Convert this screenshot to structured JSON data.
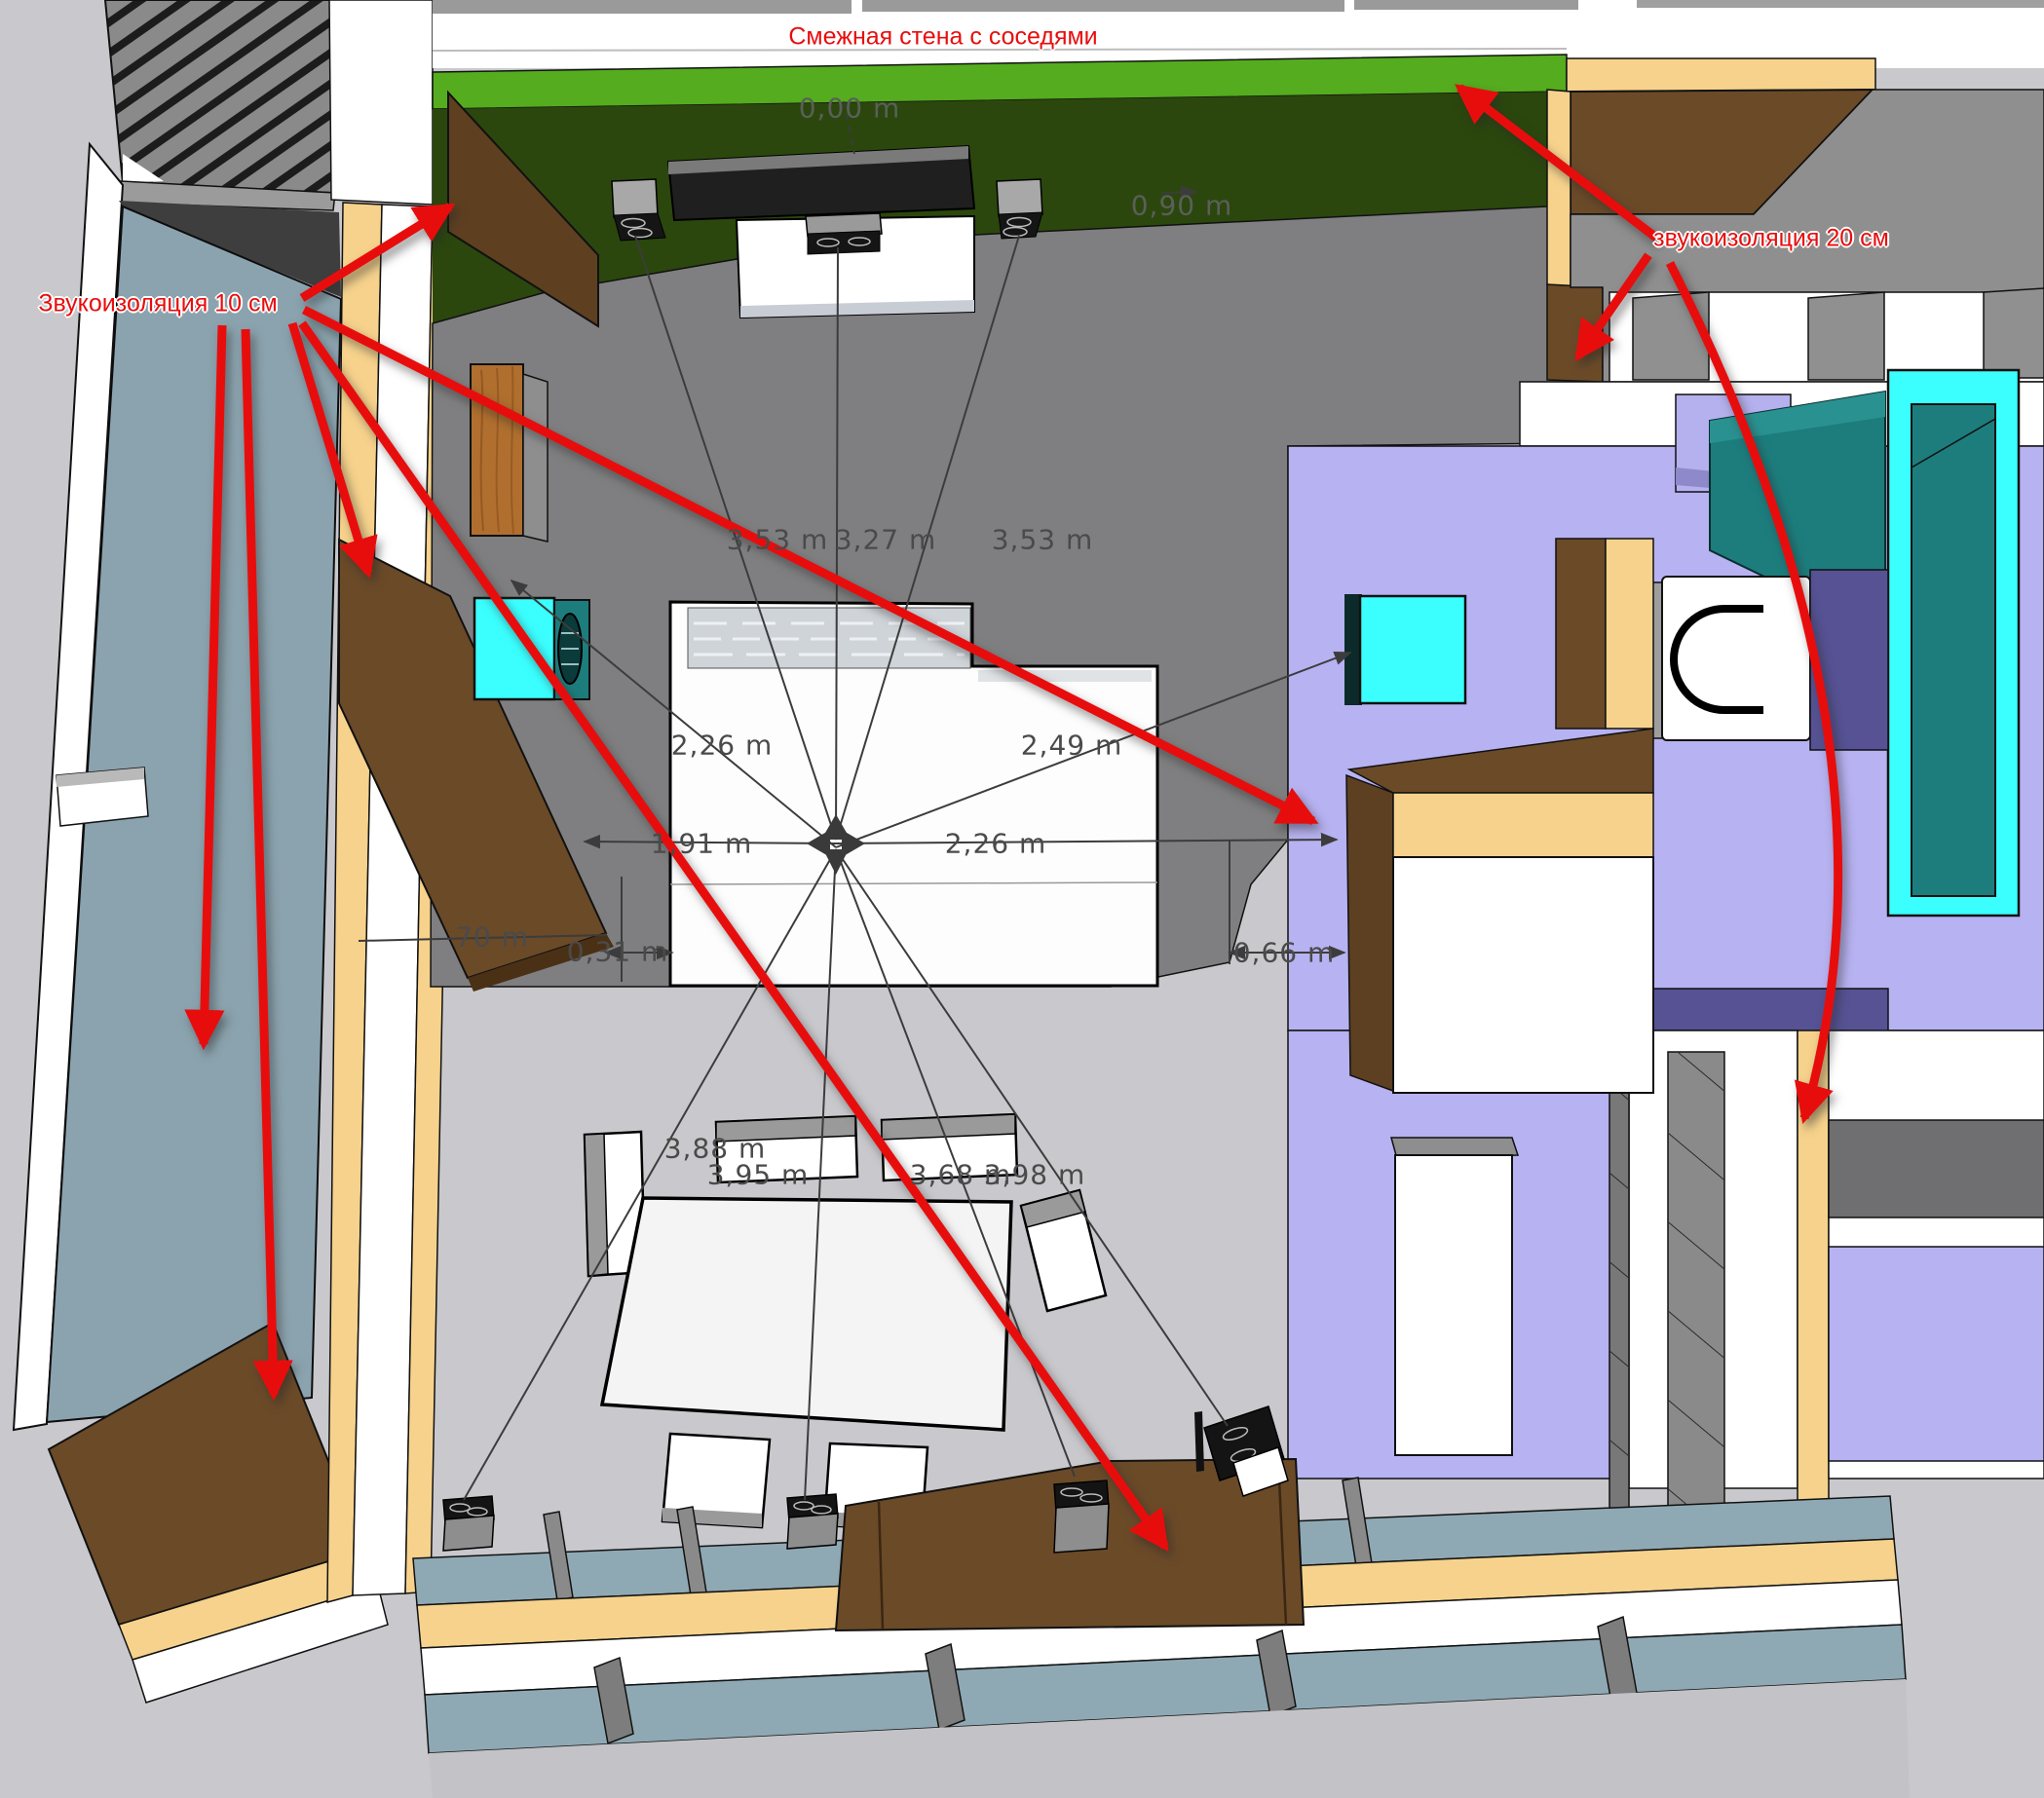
{
  "viewport": {
    "description": "3D floor-plan model view with sound-insulation annotations"
  },
  "annotations": {
    "color": "#e80d0d",
    "shared_wall_note": "Смежная стена с соседями",
    "insulation_10_note": "Звукоизоляция 10 см",
    "insulation_20_note": "звукоизоляция 20 см"
  },
  "measurements": [
    {
      "text": "0,00 m"
    },
    {
      "text": "0,90 m"
    },
    {
      "text": "3,53 m"
    },
    {
      "text": "3,27 m"
    },
    {
      "text": "3,53 m"
    },
    {
      "text": "2,26 m"
    },
    {
      "text": "2,49 m"
    },
    {
      "text": "1,91 m"
    },
    {
      "text": "2,26 m"
    },
    {
      "text": "0,31 m"
    },
    {
      "text": "0,66 m"
    },
    {
      "text": "70 m"
    },
    {
      "text": "3,88 m"
    },
    {
      "text": "3,95 m"
    },
    {
      "text": "3,68 m"
    },
    {
      "text": "3,98 m"
    }
  ],
  "colors": {
    "annotation_red": "#e80d0d",
    "green_wall_top": "#54ac1e",
    "green_wall_face": "#2b470d",
    "gray_floor": "#7f7f81",
    "purple_floor": "#b7b2f1",
    "purple_dark": "#565294",
    "tan_wall": "#f6d28c",
    "brown_insulation": "#6b4a28",
    "wood_cabinet": "#b06f2e",
    "cyan_fixture": "#3bffff",
    "teal_fixture": "#1d7d7d",
    "blue_gray_wall": "#8ba3ae",
    "dim_line": "#3c3c3c",
    "background": "#c9c9cd"
  }
}
